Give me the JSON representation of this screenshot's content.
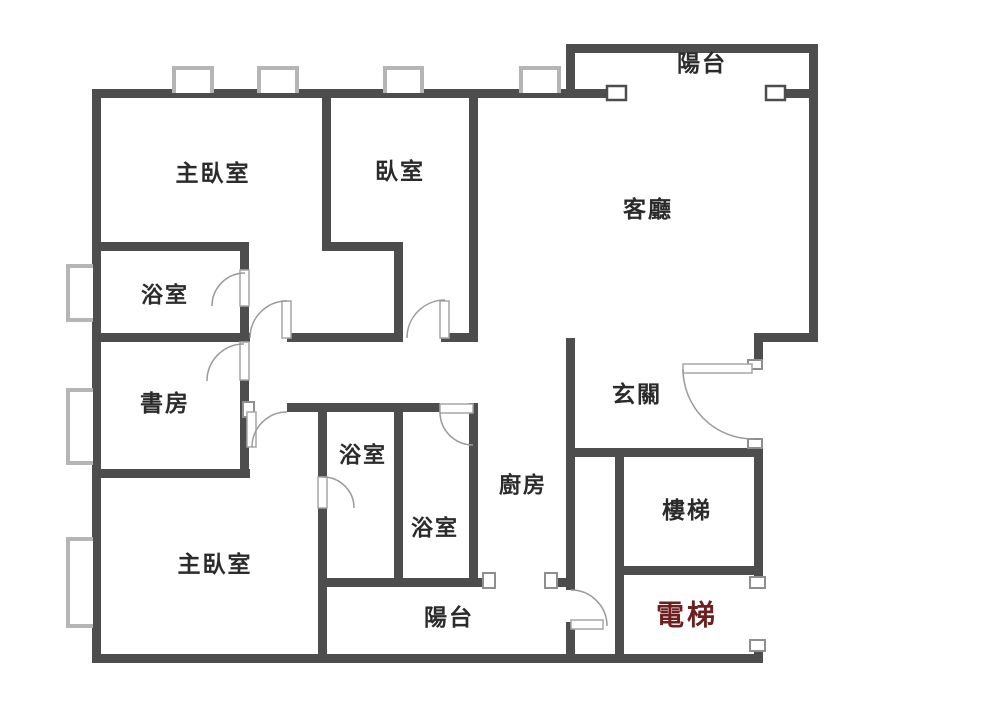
{
  "floor_plan": {
    "type": "apartment-floor-plan",
    "rooms": {
      "master_bedroom_top": "主臥室",
      "bedroom": "臥室",
      "bathroom_top": "浴室",
      "study": "書房",
      "living_room": "客廳",
      "balcony_top": "陽台",
      "entry": "玄關",
      "kitchen": "廚房",
      "bathroom_mid_upper": "浴室",
      "bathroom_mid_lower": "浴室",
      "master_bedroom_bottom": "主臥室",
      "balcony_bottom": "陽台",
      "stairs": "樓梯",
      "elevator": "電梯"
    },
    "colors": {
      "wall": "#4d4d4d",
      "label_text": "#2b2b2b",
      "elevator_text": "#6e2020",
      "window_symbol": "#b5b5b5",
      "door_symbol": "#9a9a9a",
      "background": "#ffffff"
    }
  }
}
